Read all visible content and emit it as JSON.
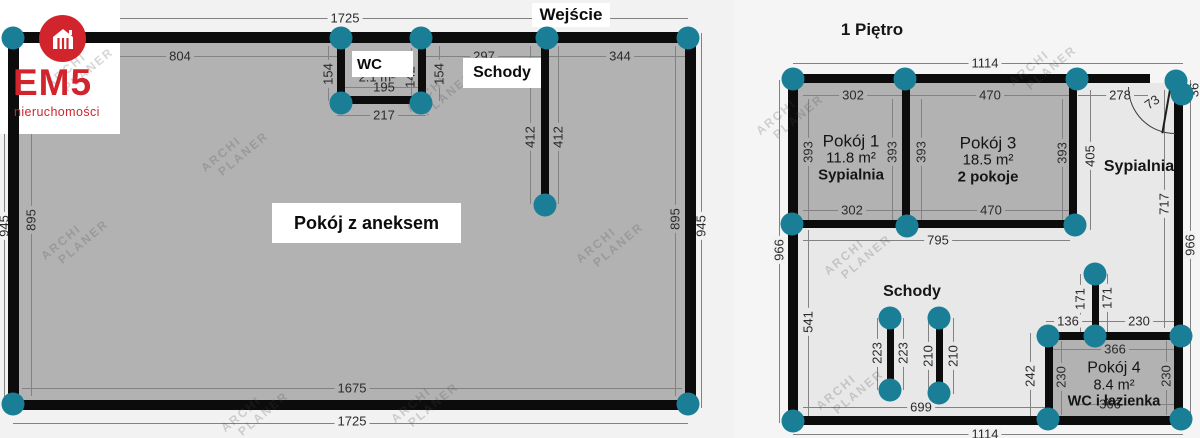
{
  "logo": {
    "brand": "EM5",
    "subtitle": "nieruchomości",
    "icon": "house-icon",
    "brand_color": "#d2242c"
  },
  "watermarks": {
    "line1": "ARCHI",
    "line2": "PLANER",
    "positions": [
      [
        80,
        68
      ],
      [
        75,
        240
      ],
      [
        235,
        152
      ],
      [
        255,
        412
      ],
      [
        440,
        92
      ],
      [
        610,
        243
      ],
      [
        425,
        403
      ],
      [
        790,
        115
      ],
      [
        858,
        255
      ],
      [
        1043,
        66
      ],
      [
        850,
        390
      ]
    ]
  },
  "colors": {
    "wall": "#0c0c0c",
    "node": "#1a7e97",
    "dim_text": "#2a2a2a",
    "surfaces": {
      "g": "#b3b2b3",
      "l": "#f3f2f3",
      "h": "#e9e8e9",
      "w": "#ffffff",
      "n": "transparent"
    }
  },
  "left_plan": {
    "entrance_label": "Wejście",
    "wc_label": "WC",
    "stairs_label": "Schody",
    "room_label": "Pokój z aneksem",
    "dimensions": [
      {
        "t": "1725",
        "x": 345,
        "y": 18,
        "bg": "l"
      },
      {
        "t": "804",
        "x": 180,
        "y": 56,
        "bg": "g"
      },
      {
        "t": "154",
        "x": 328,
        "y": 74,
        "r": 1,
        "bg": "g"
      },
      {
        "t": "154",
        "x": 439,
        "y": 74,
        "r": 1,
        "bg": "g"
      },
      {
        "t": "297",
        "x": 484,
        "y": 56,
        "bg": "g"
      },
      {
        "t": "344",
        "x": 620,
        "y": 56,
        "bg": "g"
      },
      {
        "t": "2.1 m²",
        "x": 377,
        "y": 77,
        "bg": "n"
      },
      {
        "t": "195",
        "x": 384,
        "y": 87,
        "bg": "n"
      },
      {
        "t": "142",
        "x": 410,
        "y": 77,
        "r": 1,
        "bg": "n"
      },
      {
        "t": "217",
        "x": 384,
        "y": 115,
        "bg": "g"
      },
      {
        "t": "412",
        "x": 530,
        "y": 137,
        "r": 1,
        "bg": "g"
      },
      {
        "t": "412",
        "x": 558,
        "y": 137,
        "r": 1,
        "bg": "g"
      },
      {
        "t": "895",
        "x": 31,
        "y": 220,
        "r": 1,
        "bg": "g"
      },
      {
        "t": "945",
        "x": 4,
        "y": 226,
        "r": 1,
        "bg": "l"
      },
      {
        "t": "895",
        "x": 675,
        "y": 219,
        "r": 1,
        "bg": "g"
      },
      {
        "t": "945",
        "x": 701,
        "y": 226,
        "r": 1,
        "bg": "l"
      },
      {
        "t": "1675",
        "x": 352,
        "y": 388,
        "bg": "g"
      },
      {
        "t": "1725",
        "x": 352,
        "y": 421,
        "bg": "l"
      }
    ],
    "dim_lines": [
      {
        "x": 13,
        "y": 18,
        "w": 675,
        "h": 1
      },
      {
        "x": 22,
        "y": 56,
        "w": 315,
        "h": 1
      },
      {
        "x": 426,
        "y": 56,
        "w": 115,
        "h": 1
      },
      {
        "x": 549,
        "y": 56,
        "w": 136,
        "h": 1
      },
      {
        "x": 328,
        "y": 46,
        "w": 1,
        "h": 55
      },
      {
        "x": 439,
        "y": 46,
        "w": 1,
        "h": 55
      },
      {
        "x": 345,
        "y": 87,
        "w": 73,
        "h": 1
      },
      {
        "x": 411,
        "y": 48,
        "w": 1,
        "h": 48
      },
      {
        "x": 337,
        "y": 115,
        "w": 89,
        "h": 1
      },
      {
        "x": 530,
        "y": 46,
        "w": 1,
        "h": 158
      },
      {
        "x": 558,
        "y": 46,
        "w": 1,
        "h": 158
      },
      {
        "x": 31,
        "y": 46,
        "w": 1,
        "h": 350
      },
      {
        "x": 4,
        "y": 33,
        "w": 1,
        "h": 375
      },
      {
        "x": 675,
        "y": 46,
        "w": 1,
        "h": 350
      },
      {
        "x": 701,
        "y": 33,
        "w": 1,
        "h": 375
      },
      {
        "x": 22,
        "y": 388,
        "w": 660,
        "h": 1
      },
      {
        "x": 13,
        "y": 423,
        "w": 675,
        "h": 1
      }
    ],
    "nodes": [
      [
        13,
        38
      ],
      [
        341,
        38
      ],
      [
        421,
        38
      ],
      [
        547,
        38
      ],
      [
        688,
        38
      ],
      [
        341,
        103
      ],
      [
        421,
        103
      ],
      [
        545,
        205
      ],
      [
        13,
        404
      ],
      [
        688,
        404
      ]
    ]
  },
  "right_plan": {
    "title": "1 Piętro",
    "bedroom_label": "Sypialnia",
    "stairs_label": "Schody",
    "rooms": [
      {
        "name": "Pokój 1",
        "area": "11.8 m²",
        "tag": "Sypialnia"
      },
      {
        "name": "Pokój 3",
        "area": "18.5 m²",
        "tag": "2 pokoje"
      },
      {
        "name": "Pokój 4",
        "area": "8.4 m²",
        "tag": "WC i łazienka"
      }
    ],
    "dimensions": [
      {
        "t": "1114",
        "x": 985,
        "y": 63,
        "bg": "l"
      },
      {
        "t": "302",
        "x": 853,
        "y": 95,
        "bg": "g"
      },
      {
        "t": "470",
        "x": 990,
        "y": 95,
        "bg": "g"
      },
      {
        "t": "278",
        "x": 1120,
        "y": 95,
        "bg": "h"
      },
      {
        "t": "73",
        "x": 1152,
        "y": 102,
        "rot": -35,
        "bg": "n"
      },
      {
        "t": "36",
        "x": 1194,
        "y": 90,
        "r": 1,
        "bg": "n"
      },
      {
        "t": "393",
        "x": 808,
        "y": 152,
        "r": 1,
        "bg": "g"
      },
      {
        "t": "393",
        "x": 892,
        "y": 152,
        "r": 1,
        "bg": "g"
      },
      {
        "t": "393",
        "x": 921,
        "y": 152,
        "r": 1,
        "bg": "g"
      },
      {
        "t": "393",
        "x": 1062,
        "y": 153,
        "r": 1,
        "bg": "g"
      },
      {
        "t": "405",
        "x": 1090,
        "y": 156,
        "r": 1,
        "bg": "h"
      },
      {
        "t": "302",
        "x": 852,
        "y": 210,
        "bg": "g"
      },
      {
        "t": "470",
        "x": 991,
        "y": 210,
        "bg": "g"
      },
      {
        "t": "795",
        "x": 938,
        "y": 240,
        "bg": "h"
      },
      {
        "t": "717",
        "x": 1164,
        "y": 204,
        "r": 1,
        "bg": "h"
      },
      {
        "t": "966",
        "x": 1190,
        "y": 245,
        "r": 1,
        "bg": "l"
      },
      {
        "t": "966",
        "x": 779,
        "y": 250,
        "r": 1,
        "bg": "l"
      },
      {
        "t": "541",
        "x": 808,
        "y": 322,
        "r": 1,
        "bg": "h"
      },
      {
        "t": "223",
        "x": 877,
        "y": 353,
        "r": 1,
        "bg": "h"
      },
      {
        "t": "223",
        "x": 903,
        "y": 353,
        "r": 1,
        "bg": "h"
      },
      {
        "t": "210",
        "x": 928,
        "y": 356,
        "r": 1,
        "bg": "h"
      },
      {
        "t": "210",
        "x": 953,
        "y": 356,
        "r": 1,
        "bg": "h"
      },
      {
        "t": "699",
        "x": 921,
        "y": 407,
        "bg": "h"
      },
      {
        "t": "171",
        "x": 1080,
        "y": 299,
        "r": 1,
        "bg": "h"
      },
      {
        "t": "171",
        "x": 1107,
        "y": 298,
        "r": 1,
        "bg": "h"
      },
      {
        "t": "136",
        "x": 1068,
        "y": 321,
        "bg": "h"
      },
      {
        "t": "230",
        "x": 1139,
        "y": 321,
        "bg": "h"
      },
      {
        "t": "366",
        "x": 1115,
        "y": 349,
        "bg": "g"
      },
      {
        "t": "242",
        "x": 1030,
        "y": 376,
        "r": 1,
        "bg": "h"
      },
      {
        "t": "230",
        "x": 1061,
        "y": 377,
        "r": 1,
        "bg": "g"
      },
      {
        "t": "230",
        "x": 1166,
        "y": 376,
        "r": 1,
        "bg": "g"
      },
      {
        "t": "366",
        "x": 1110,
        "y": 404,
        "bg": "n"
      },
      {
        "t": "1114",
        "x": 985,
        "y": 434,
        "bg": "l"
      }
    ],
    "dim_lines": [
      {
        "x": 793,
        "y": 63,
        "w": 390,
        "h": 1
      },
      {
        "x": 803,
        "y": 95,
        "w": 99,
        "h": 1
      },
      {
        "x": 910,
        "y": 95,
        "w": 159,
        "h": 1
      },
      {
        "x": 1078,
        "y": 95,
        "w": 70,
        "h": 1
      },
      {
        "x": 808,
        "y": 99,
        "w": 1,
        "h": 121
      },
      {
        "x": 892,
        "y": 99,
        "w": 1,
        "h": 121
      },
      {
        "x": 921,
        "y": 99,
        "w": 1,
        "h": 121
      },
      {
        "x": 1062,
        "y": 99,
        "w": 1,
        "h": 121
      },
      {
        "x": 1090,
        "y": 90,
        "w": 1,
        "h": 140
      },
      {
        "x": 803,
        "y": 210,
        "w": 99,
        "h": 1
      },
      {
        "x": 910,
        "y": 210,
        "w": 159,
        "h": 1
      },
      {
        "x": 803,
        "y": 240,
        "w": 267,
        "h": 1
      },
      {
        "x": 1164,
        "y": 90,
        "w": 1,
        "h": 238
      },
      {
        "x": 1190,
        "y": 80,
        "w": 1,
        "h": 343
      },
      {
        "x": 779,
        "y": 80,
        "w": 1,
        "h": 343
      },
      {
        "x": 808,
        "y": 230,
        "w": 1,
        "h": 186
      },
      {
        "x": 877,
        "y": 318,
        "w": 1,
        "h": 72
      },
      {
        "x": 903,
        "y": 318,
        "w": 1,
        "h": 72
      },
      {
        "x": 928,
        "y": 318,
        "w": 1,
        "h": 76
      },
      {
        "x": 953,
        "y": 318,
        "w": 1,
        "h": 76
      },
      {
        "x": 803,
        "y": 407,
        "w": 242,
        "h": 1
      },
      {
        "x": 1080,
        "y": 274,
        "w": 1,
        "h": 58
      },
      {
        "x": 1107,
        "y": 274,
        "w": 1,
        "h": 58
      },
      {
        "x": 1046,
        "y": 321,
        "w": 46,
        "h": 1
      },
      {
        "x": 1099,
        "y": 321,
        "w": 84,
        "h": 1
      },
      {
        "x": 1053,
        "y": 349,
        "w": 121,
        "h": 1
      },
      {
        "x": 1030,
        "y": 333,
        "w": 1,
        "h": 88
      },
      {
        "x": 1061,
        "y": 341,
        "w": 1,
        "h": 74
      },
      {
        "x": 1166,
        "y": 341,
        "w": 1,
        "h": 74
      },
      {
        "x": 1079,
        "y": 404,
        "w": 97,
        "h": 1
      },
      {
        "x": 793,
        "y": 434,
        "w": 390,
        "h": 1
      }
    ],
    "nodes": [
      [
        793,
        79
      ],
      [
        905,
        79
      ],
      [
        1077,
        79
      ],
      [
        1176,
        81
      ],
      [
        1182,
        94
      ],
      [
        792,
        224
      ],
      [
        907,
        226
      ],
      [
        1075,
        225
      ],
      [
        890,
        318
      ],
      [
        890,
        390
      ],
      [
        939,
        318
      ],
      [
        939,
        393
      ],
      [
        1095,
        274
      ],
      [
        1095,
        336
      ],
      [
        1048,
        336
      ],
      [
        1181,
        336
      ],
      [
        793,
        421
      ],
      [
        1048,
        419
      ],
      [
        1181,
        419
      ]
    ]
  }
}
